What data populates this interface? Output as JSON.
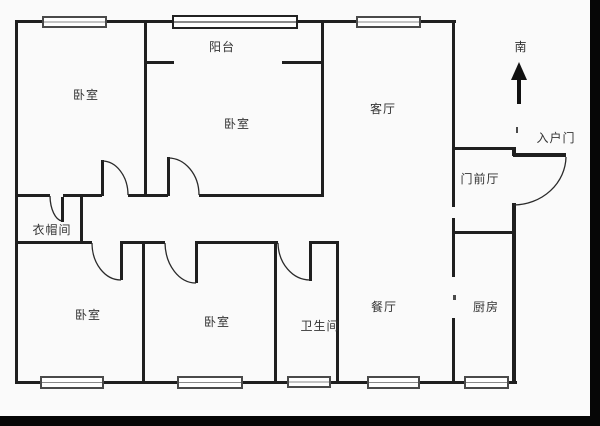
{
  "title": "户型图",
  "colors": {
    "wall": "#1f1f1f",
    "background": "#fafafa",
    "text": "#333333",
    "crop_bar": "#060606",
    "window_frame": "#4a4a4a"
  },
  "compass": {
    "label": "南",
    "direction": "up"
  },
  "entrance": {
    "label": "入户门"
  },
  "rooms": [
    {
      "id": "balcony",
      "label": "阳台"
    },
    {
      "id": "bedroom-top-left",
      "label": "卧室"
    },
    {
      "id": "bedroom-top-middle",
      "label": "卧室"
    },
    {
      "id": "living-room",
      "label": "客厅"
    },
    {
      "id": "front-hall",
      "label": "门前厅"
    },
    {
      "id": "cloakroom",
      "label": "衣帽间"
    },
    {
      "id": "bedroom-bottom-left",
      "label": "卧室"
    },
    {
      "id": "bedroom-bottom-middle",
      "label": "卧室"
    },
    {
      "id": "bathroom",
      "label": "卫生间"
    },
    {
      "id": "dining-room",
      "label": "餐厅"
    },
    {
      "id": "kitchen",
      "label": "厨房"
    }
  ]
}
